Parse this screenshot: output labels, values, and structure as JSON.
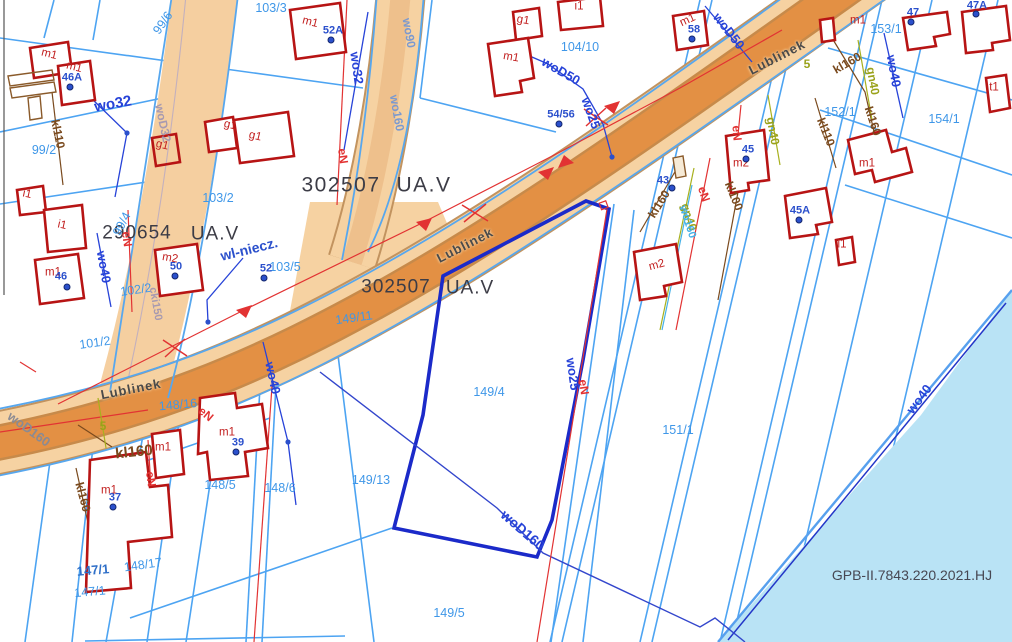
{
  "map": {
    "reference_number": "GPB-II.7843.220.2021.HJ",
    "street_name": "Lublinek",
    "zones": [
      {
        "code": "302507",
        "class": "UA.V"
      },
      {
        "code": "290654",
        "class": "UA.V"
      },
      {
        "code": "302507",
        "class": "UA.V"
      }
    ],
    "colors": {
      "parcel_line": "#4da4f2",
      "selected_parcel": "#1b2ac9",
      "building": "#b71414",
      "road_fill": "#f6d2a2",
      "road_core": "#e39044",
      "water": "#b9e3f5",
      "power_line": "#e23333",
      "sewer_line": "#7a4a1e",
      "gas_line": "#9aa21a",
      "water_line": "#2743d8"
    },
    "labels": [
      {
        "name": "zone-code",
        "text": "302507",
        "x": 341,
        "y": 185,
        "rot": 0,
        "cls": "zone"
      },
      {
        "name": "zone-class",
        "text": "UA.V",
        "x": 424,
        "y": 185,
        "rot": 0,
        "cls": "zone"
      },
      {
        "name": "zone-code",
        "text": "290654",
        "x": 137,
        "y": 233,
        "rot": 0,
        "cls": "zone2"
      },
      {
        "name": "zone-class",
        "text": "UA.V",
        "x": 215,
        "y": 234,
        "rot": 0,
        "cls": "zone2"
      },
      {
        "name": "zone-code",
        "text": "302507",
        "x": 396,
        "y": 287,
        "rot": 0,
        "cls": "zone2"
      },
      {
        "name": "zone-class",
        "text": "UA.V",
        "x": 470,
        "y": 288,
        "rot": 0,
        "cls": "zone2"
      },
      {
        "name": "street-label",
        "text": "Lublinek",
        "x": 465,
        "y": 245,
        "rot": -27,
        "cls": "street"
      },
      {
        "name": "street-label",
        "text": "Lublinek",
        "x": 777,
        "y": 57,
        "rot": -27,
        "cls": "street"
      },
      {
        "name": "street-label",
        "text": "Lublinek",
        "x": 131,
        "y": 389,
        "rot": -11,
        "cls": "street"
      },
      {
        "name": "note-label",
        "text": "wl-niecz.",
        "x": 249,
        "y": 249,
        "rot": -14,
        "cls": "note"
      },
      {
        "name": "reference-number",
        "text": "GPB-II.7843.220.2021.HJ",
        "x": 912,
        "y": 575,
        "rot": 0,
        "cls": "ref"
      },
      {
        "name": "parcel-label",
        "text": "99/2",
        "x": 44,
        "y": 150,
        "rot": 0,
        "cls": "parcel"
      },
      {
        "name": "parcel-label",
        "text": "99/6",
        "x": 163,
        "y": 23,
        "rot": -55,
        "cls": "parcel"
      },
      {
        "name": "parcel-label",
        "text": "99/4",
        "x": 122,
        "y": 224,
        "rot": -62,
        "cls": "parcel"
      },
      {
        "name": "parcel-label",
        "text": "103/3",
        "x": 271,
        "y": 8,
        "rot": 0,
        "cls": "parcel"
      },
      {
        "name": "parcel-label",
        "text": "103/2",
        "x": 218,
        "y": 198,
        "rot": 0,
        "cls": "parcel"
      },
      {
        "name": "parcel-label",
        "text": "103/5",
        "x": 285,
        "y": 267,
        "rot": 0,
        "cls": "parcel"
      },
      {
        "name": "parcel-label",
        "text": "102/2",
        "x": 136,
        "y": 290,
        "rot": -8,
        "cls": "parcel"
      },
      {
        "name": "parcel-label",
        "text": "101/2",
        "x": 95,
        "y": 343,
        "rot": -8,
        "cls": "parcel"
      },
      {
        "name": "parcel-label",
        "text": "104/10",
        "x": 580,
        "y": 47,
        "rot": 0,
        "cls": "parcel"
      },
      {
        "name": "parcel-label",
        "text": "153/1",
        "x": 886,
        "y": 29,
        "rot": 0,
        "cls": "parcel"
      },
      {
        "name": "parcel-label",
        "text": "152/1",
        "x": 840,
        "y": 112,
        "rot": 0,
        "cls": "parcel"
      },
      {
        "name": "parcel-label",
        "text": "154/1",
        "x": 944,
        "y": 119,
        "rot": 0,
        "cls": "parcel"
      },
      {
        "name": "parcel-label",
        "text": "151/1",
        "x": 678,
        "y": 430,
        "rot": 0,
        "cls": "parcel"
      },
      {
        "name": "parcel-label",
        "text": "149/11",
        "x": 354,
        "y": 318,
        "rot": -8,
        "cls": "parcel"
      },
      {
        "name": "parcel-label",
        "text": "149/4",
        "x": 489,
        "y": 392,
        "rot": 0,
        "cls": "parcel"
      },
      {
        "name": "parcel-label",
        "text": "149/13",
        "x": 371,
        "y": 480,
        "rot": 0,
        "cls": "parcel"
      },
      {
        "name": "parcel-label",
        "text": "149/5",
        "x": 449,
        "y": 613,
        "rot": 0,
        "cls": "parcel"
      },
      {
        "name": "parcel-label",
        "text": "148/16",
        "x": 178,
        "y": 405,
        "rot": -5,
        "cls": "parcel"
      },
      {
        "name": "parcel-label",
        "text": "148/5",
        "x": 220,
        "y": 485,
        "rot": 0,
        "cls": "parcel"
      },
      {
        "name": "parcel-label",
        "text": "148/6",
        "x": 280,
        "y": 488,
        "rot": 0,
        "cls": "parcel"
      },
      {
        "name": "parcel-label",
        "text": "148/17",
        "x": 143,
        "y": 565,
        "rot": -8,
        "cls": "parcel"
      },
      {
        "name": "parcel-label",
        "text": "147/1",
        "x": 93,
        "y": 570,
        "rot": -5,
        "cls": "parcel-dk"
      },
      {
        "name": "parcel-label",
        "text": "147/1",
        "x": 90,
        "y": 592,
        "rot": -5,
        "cls": "parcel"
      },
      {
        "name": "building-label",
        "text": "m1",
        "x": 49,
        "y": 55,
        "rot": 14,
        "cls": "bld"
      },
      {
        "name": "building-label",
        "text": "m1",
        "x": 74,
        "y": 68,
        "rot": 14,
        "cls": "bld"
      },
      {
        "name": "building-label",
        "text": "m1",
        "x": 310,
        "y": 23,
        "rot": 14,
        "cls": "bld"
      },
      {
        "name": "building-label",
        "text": "m1",
        "x": 511,
        "y": 58,
        "rot": 10,
        "cls": "bld"
      },
      {
        "name": "building-label",
        "text": "m1",
        "x": 688,
        "y": 21,
        "rot": -25,
        "cls": "bld"
      },
      {
        "name": "building-label",
        "text": "m1",
        "x": 858,
        "y": 21,
        "rot": 0,
        "cls": "bld"
      },
      {
        "name": "building-label",
        "text": "m1",
        "x": 867,
        "y": 164,
        "rot": 0,
        "cls": "bld"
      },
      {
        "name": "building-label",
        "text": "m1",
        "x": 227,
        "y": 433,
        "rot": 0,
        "cls": "bld"
      },
      {
        "name": "building-label",
        "text": "m1",
        "x": 163,
        "y": 448,
        "rot": 0,
        "cls": "bld"
      },
      {
        "name": "building-label",
        "text": "m1",
        "x": 109,
        "y": 491,
        "rot": 0,
        "cls": "bld"
      },
      {
        "name": "building-label",
        "text": "m1",
        "x": 53,
        "y": 273,
        "rot": 0,
        "cls": "bld"
      },
      {
        "name": "building-label",
        "text": "m2",
        "x": 170,
        "y": 259,
        "rot": 10,
        "cls": "bld"
      },
      {
        "name": "building-label",
        "text": "m2",
        "x": 657,
        "y": 266,
        "rot": -15,
        "cls": "bld"
      },
      {
        "name": "building-label",
        "text": "m2",
        "x": 741,
        "y": 164,
        "rot": 0,
        "cls": "bld"
      },
      {
        "name": "building-label",
        "text": "g1",
        "x": 162,
        "y": 146,
        "rot": 14,
        "cls": "bld"
      },
      {
        "name": "building-label",
        "text": "g1",
        "x": 230,
        "y": 126,
        "rot": 14,
        "cls": "bld"
      },
      {
        "name": "building-label",
        "text": "g1",
        "x": 255,
        "y": 137,
        "rot": 14,
        "cls": "bld"
      },
      {
        "name": "building-label",
        "text": "g1",
        "x": 523,
        "y": 21,
        "rot": 10,
        "cls": "bld"
      },
      {
        "name": "building-label",
        "text": "i1",
        "x": 27,
        "y": 195,
        "rot": 12,
        "cls": "bld"
      },
      {
        "name": "building-label",
        "text": "i1",
        "x": 62,
        "y": 226,
        "rot": 12,
        "cls": "bld"
      },
      {
        "name": "building-label",
        "text": "i1",
        "x": 579,
        "y": 7,
        "rot": 0,
        "cls": "bld"
      },
      {
        "name": "building-label",
        "text": "i1",
        "x": 842,
        "y": 245,
        "rot": 0,
        "cls": "bld"
      },
      {
        "name": "building-label",
        "text": "t1",
        "x": 994,
        "y": 88,
        "rot": 0,
        "cls": "bld"
      },
      {
        "name": "utility-label",
        "text": "wo32",
        "x": 113,
        "y": 104,
        "rot": -10,
        "cls": "ub",
        "fs": 15
      },
      {
        "name": "utility-label",
        "text": "wo32",
        "x": 357,
        "y": 68,
        "rot": 82,
        "cls": "ub"
      },
      {
        "name": "utility-label",
        "text": "wo40",
        "x": 104,
        "y": 267,
        "rot": 80,
        "cls": "ub"
      },
      {
        "name": "utility-label",
        "text": "wo40",
        "x": 273,
        "y": 378,
        "rot": 78,
        "cls": "ub"
      },
      {
        "name": "utility-label",
        "text": "wo40",
        "x": 894,
        "y": 71,
        "rot": 80,
        "cls": "ub"
      },
      {
        "name": "utility-label",
        "text": "wo40",
        "x": 919,
        "y": 399,
        "rot": -53,
        "cls": "ub"
      },
      {
        "name": "utility-label",
        "text": "wo90",
        "x": 409,
        "y": 33,
        "rot": 80,
        "cls": "ubg"
      },
      {
        "name": "utility-label",
        "text": "wo160",
        "x": 397,
        "y": 113,
        "rot": 80,
        "cls": "ubg"
      },
      {
        "name": "utility-label",
        "text": "wo25",
        "x": 591,
        "y": 113,
        "rot": 70,
        "cls": "ub"
      },
      {
        "name": "utility-label",
        "text": "wo25",
        "x": 573,
        "y": 374,
        "rot": 82,
        "cls": "ub"
      },
      {
        "name": "utility-label",
        "text": "woD50",
        "x": 561,
        "y": 71,
        "rot": 30,
        "cls": "ub"
      },
      {
        "name": "utility-label",
        "text": "woD50",
        "x": 729,
        "y": 31,
        "rot": 52,
        "cls": "ub"
      },
      {
        "name": "utility-label",
        "text": "woD160",
        "x": 523,
        "y": 530,
        "rot": 41,
        "cls": "ub",
        "fs": 14
      },
      {
        "name": "utility-label",
        "text": "woD160",
        "x": 29,
        "y": 429,
        "rot": 36,
        "cls": "gray"
      },
      {
        "name": "utility-label",
        "text": "woD32",
        "x": 163,
        "y": 123,
        "rot": 78,
        "cls": "gray2"
      },
      {
        "name": "utility-label",
        "text": "cki150",
        "x": 155,
        "y": 304,
        "rot": 80,
        "cls": "gray2",
        "fs": 11
      },
      {
        "name": "utility-label",
        "text": "eN",
        "x": 343,
        "y": 156,
        "rot": 82,
        "cls": "red"
      },
      {
        "name": "utility-label",
        "text": "eN",
        "x": 127,
        "y": 239,
        "rot": 82,
        "cls": "red"
      },
      {
        "name": "utility-label",
        "text": "eN",
        "x": 206,
        "y": 414,
        "rot": 40,
        "cls": "red"
      },
      {
        "name": "utility-label",
        "text": "eN",
        "x": 151,
        "y": 479,
        "rot": 82,
        "cls": "red"
      },
      {
        "name": "utility-label",
        "text": "eN",
        "x": 584,
        "y": 387,
        "rot": 82,
        "cls": "red"
      },
      {
        "name": "utility-label",
        "text": "eN",
        "x": 704,
        "y": 194,
        "rot": 72,
        "cls": "red"
      },
      {
        "name": "utility-label",
        "text": "eN",
        "x": 737,
        "y": 133,
        "rot": 85,
        "cls": "red"
      },
      {
        "name": "utility-label",
        "text": "kl110",
        "x": 58,
        "y": 134,
        "rot": 78,
        "cls": "brown"
      },
      {
        "name": "utility-label",
        "text": "kl160",
        "x": 134,
        "y": 452,
        "rot": -6,
        "cls": "brown",
        "fs": 15
      },
      {
        "name": "utility-label",
        "text": "kl160",
        "x": 83,
        "y": 497,
        "rot": 75,
        "cls": "brown"
      },
      {
        "name": "utility-label",
        "text": "kl160",
        "x": 659,
        "y": 204,
        "rot": -58,
        "cls": "brown"
      },
      {
        "name": "utility-label",
        "text": "kl100",
        "x": 734,
        "y": 196,
        "rot": 68,
        "cls": "brown"
      },
      {
        "name": "utility-label",
        "text": "kl160",
        "x": 847,
        "y": 63,
        "rot": -30,
        "cls": "brown"
      },
      {
        "name": "utility-label",
        "text": "kl160",
        "x": 873,
        "y": 121,
        "rot": 72,
        "cls": "brown"
      },
      {
        "name": "utility-label",
        "text": "kl110",
        "x": 826,
        "y": 132,
        "rot": 68,
        "cls": "brown"
      },
      {
        "name": "utility-label",
        "text": "gn40",
        "x": 689,
        "y": 217,
        "rot": 72,
        "cls": "olive"
      },
      {
        "name": "utility-label",
        "text": "gn40",
        "x": 773,
        "y": 131,
        "rot": 80,
        "cls": "olive"
      },
      {
        "name": "utility-label",
        "text": "gn40",
        "x": 873,
        "y": 81,
        "rot": 80,
        "cls": "olive"
      },
      {
        "name": "utility-label",
        "text": "wo160",
        "x": 687,
        "y": 222,
        "rot": 72,
        "cls": "ublight"
      },
      {
        "name": "utility-label",
        "text": "5",
        "x": 103,
        "y": 426,
        "rot": 0,
        "cls": "olive"
      },
      {
        "name": "utility-label",
        "text": "5",
        "x": 807,
        "y": 64,
        "rot": 0,
        "cls": "olive"
      }
    ],
    "address_points": [
      {
        "name": "address-point",
        "text": "46",
        "tx": 61,
        "ty": 277,
        "dx": 67,
        "dy": 287
      },
      {
        "name": "address-point",
        "text": "46A",
        "tx": 72,
        "ty": 78,
        "dx": 70,
        "dy": 87
      },
      {
        "name": "address-point",
        "text": "52A",
        "tx": 333,
        "ty": 31,
        "dx": 331,
        "dy": 40
      },
      {
        "name": "address-point",
        "text": "58",
        "tx": 694,
        "ty": 30,
        "dx": 692,
        "dy": 39
      },
      {
        "name": "address-point",
        "text": "52",
        "tx": 266,
        "ty": 269,
        "dx": 264,
        "dy": 278
      },
      {
        "name": "address-point",
        "text": "50",
        "tx": 176,
        "ty": 267,
        "dx": 175,
        "dy": 276
      },
      {
        "name": "address-point",
        "text": "39",
        "tx": 238,
        "ty": 443,
        "dx": 236,
        "dy": 452
      },
      {
        "name": "address-point",
        "text": "37",
        "tx": 115,
        "ty": 498,
        "dx": 113,
        "dy": 507
      },
      {
        "name": "address-point",
        "text": "45",
        "tx": 748,
        "ty": 150,
        "dx": 746,
        "dy": 159
      },
      {
        "name": "address-point",
        "text": "45A",
        "tx": 800,
        "ty": 211,
        "dx": 799,
        "dy": 220
      },
      {
        "name": "address-point",
        "text": "43",
        "tx": 663,
        "ty": 181,
        "dx": 672,
        "dy": 188
      },
      {
        "name": "address-point",
        "text": "47",
        "tx": 913,
        "ty": 13,
        "dx": 911,
        "dy": 22
      },
      {
        "name": "address-point",
        "text": "47A",
        "tx": 977,
        "ty": 6,
        "dx": 976,
        "dy": 14
      },
      {
        "name": "address-point",
        "text": "54/56",
        "tx": 561,
        "ty": 115,
        "dx": 559,
        "dy": 124
      }
    ]
  }
}
